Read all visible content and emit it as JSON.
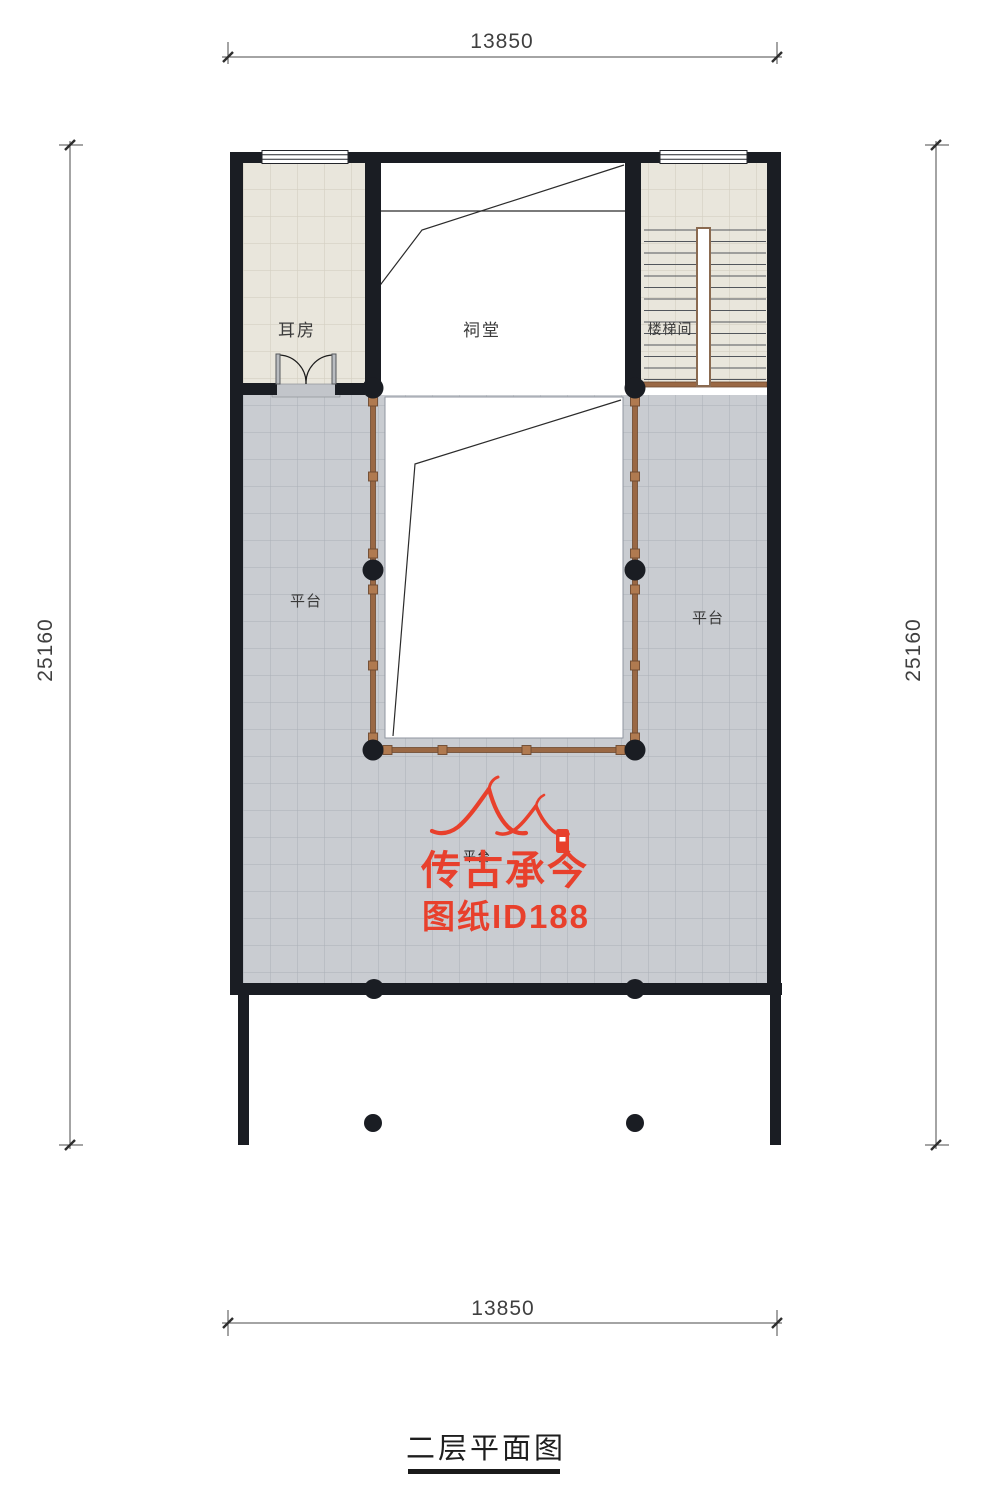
{
  "title_block": {
    "title": "二层平面图"
  },
  "dimensions": {
    "top": "13850",
    "bottom": "13850",
    "left": "25160",
    "right": "25160"
  },
  "labels": {
    "erfang": "耳房",
    "citang": "祠堂",
    "loutijian": "楼梯间",
    "pingtai_left": "平台",
    "pingtai_right": "平台",
    "pingtai_center": "平台"
  },
  "watermark": {
    "brand": "传古承今",
    "sheet_id": "图纸ID188"
  },
  "colors": {
    "wall": "#1a1d23",
    "tile_beige": "#e9e6dc",
    "tile_gray": "#c9ccd1",
    "railing": "#9a6844",
    "watermark_red": "#e8402c"
  }
}
